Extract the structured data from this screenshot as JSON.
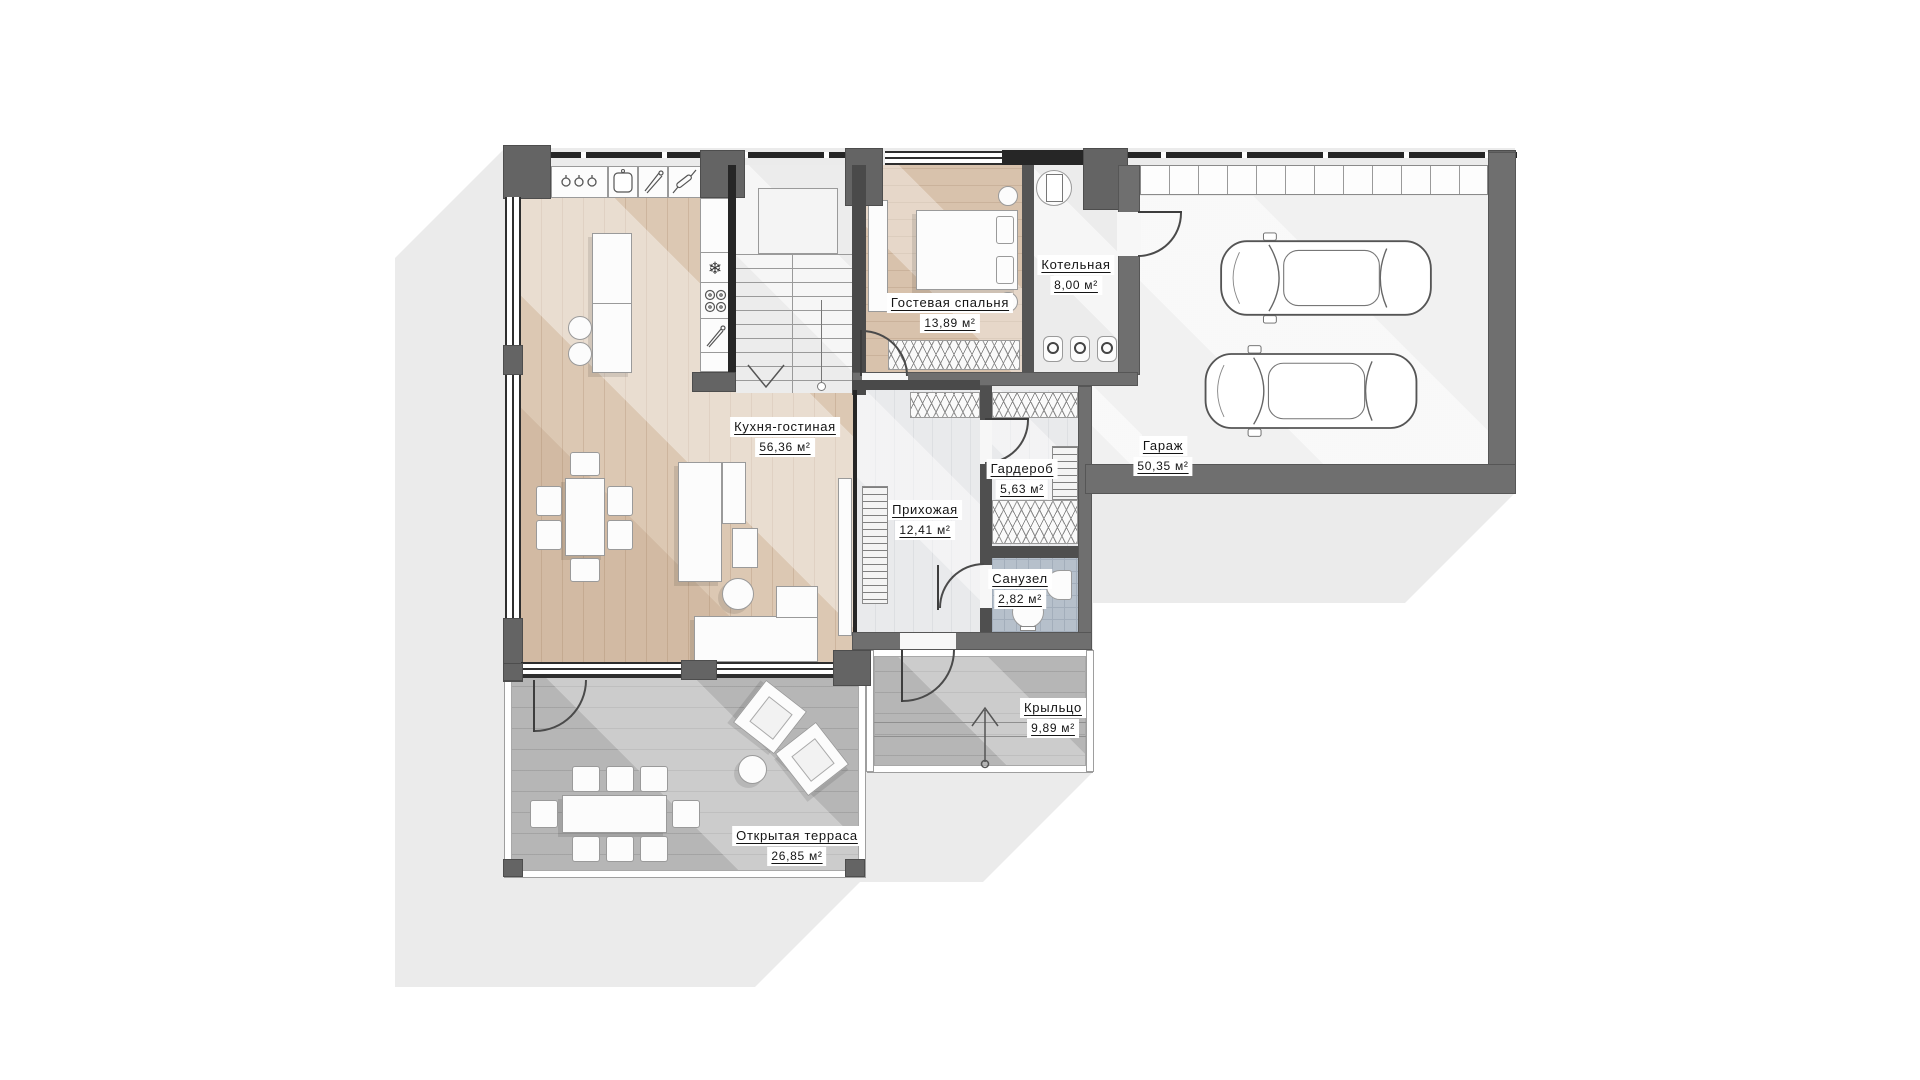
{
  "floorplan": {
    "rooms": [
      {
        "name": "Кухня-гостиная",
        "area": "56,36 м²"
      },
      {
        "name": "Гостевая спальня",
        "area": "13,89 м²"
      },
      {
        "name": "Котельная",
        "area": "8,00 м²"
      },
      {
        "name": "Гараж",
        "area": "50,35 м²"
      },
      {
        "name": "Гардероб",
        "area": "5,63 м²"
      },
      {
        "name": "Прихожая",
        "area": "12,41 м²"
      },
      {
        "name": "Санузел",
        "area": "2,82 м²"
      },
      {
        "name": "Крыльцо",
        "area": "9,89 м²"
      },
      {
        "name": "Открытая терраса",
        "area": "26,85 м²"
      }
    ],
    "icons": {
      "vent": "❄"
    },
    "colors": {
      "wall_dark": "#646464",
      "wall_line": "#262626",
      "wood_floor": "#dcc8b3",
      "deck": "#b6b6b6",
      "tile": "#b6c0cb",
      "shadow": "#ebebeb"
    }
  }
}
